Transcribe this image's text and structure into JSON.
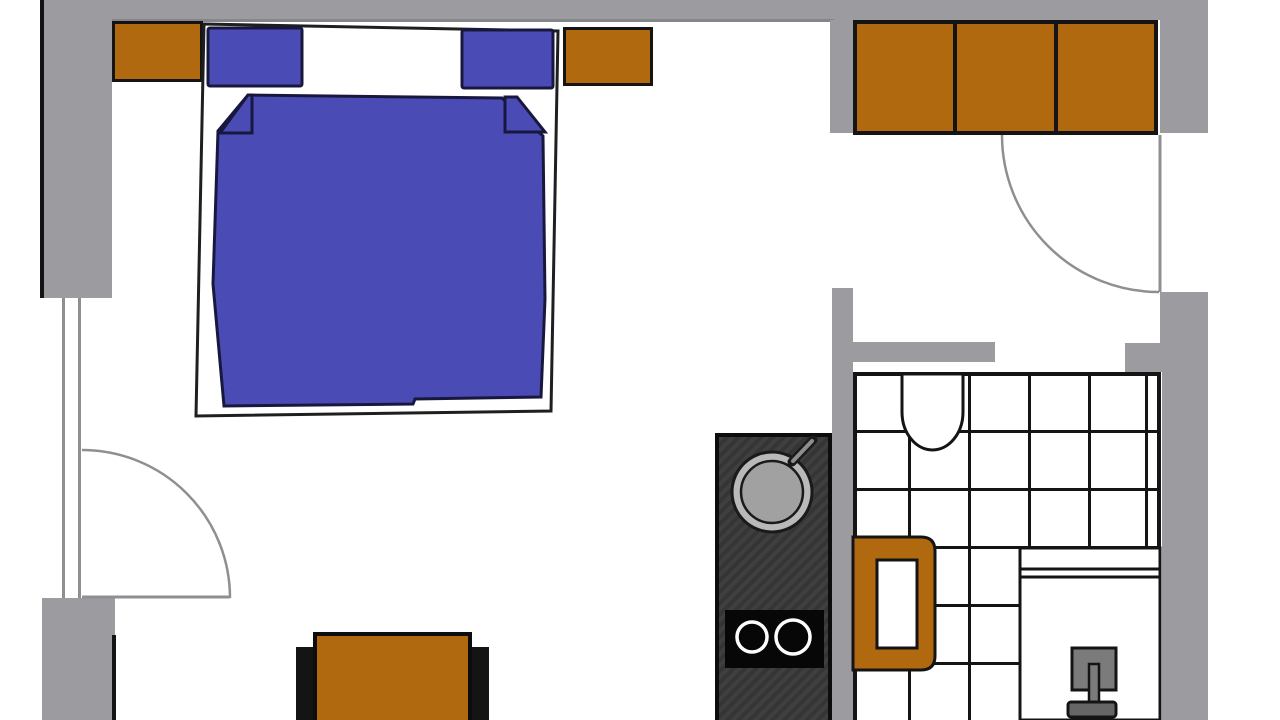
{
  "title": "apartment-floor-plan",
  "palette": {
    "wall": "#9c9ca0",
    "wall-dark": "#85858a",
    "line": "#141414",
    "orange": "#b0690f",
    "blue": "#4a4bb5",
    "navy": "#18183f",
    "door": "#8f8f93",
    "counter": "#3c3c3c",
    "cooktop": "#070707",
    "sink-outer": "#b9b9b9",
    "sink-inner": "#a1a1a1",
    "burner": "#ffffff",
    "chair": "#7b7b7b",
    "chair-base": "#666666",
    "floor": "#ffffff"
  },
  "apartment": {
    "rooms": [
      "bedroom-living-area",
      "entrance-hallway",
      "kitchen-niche",
      "bathroom"
    ],
    "furniture": [
      "double-bed",
      "pillow-left",
      "pillow-right",
      "blanket",
      "nightstand-left",
      "nightstand-right",
      "wardrobe-three-door",
      "sofa",
      "kitchen-counter",
      "kitchen-round-sink",
      "two-burner-cooktop",
      "washbasin",
      "toilet",
      "shower-cabin",
      "shower-seat"
    ],
    "openings": [
      "balcony-window-left",
      "interior-door-left",
      "entrance-door-right",
      "bathroom-doorway"
    ],
    "bathroom_floor": "tiled-grid",
    "wardrobe_sections": 3,
    "cooktop_burners": 2
  }
}
